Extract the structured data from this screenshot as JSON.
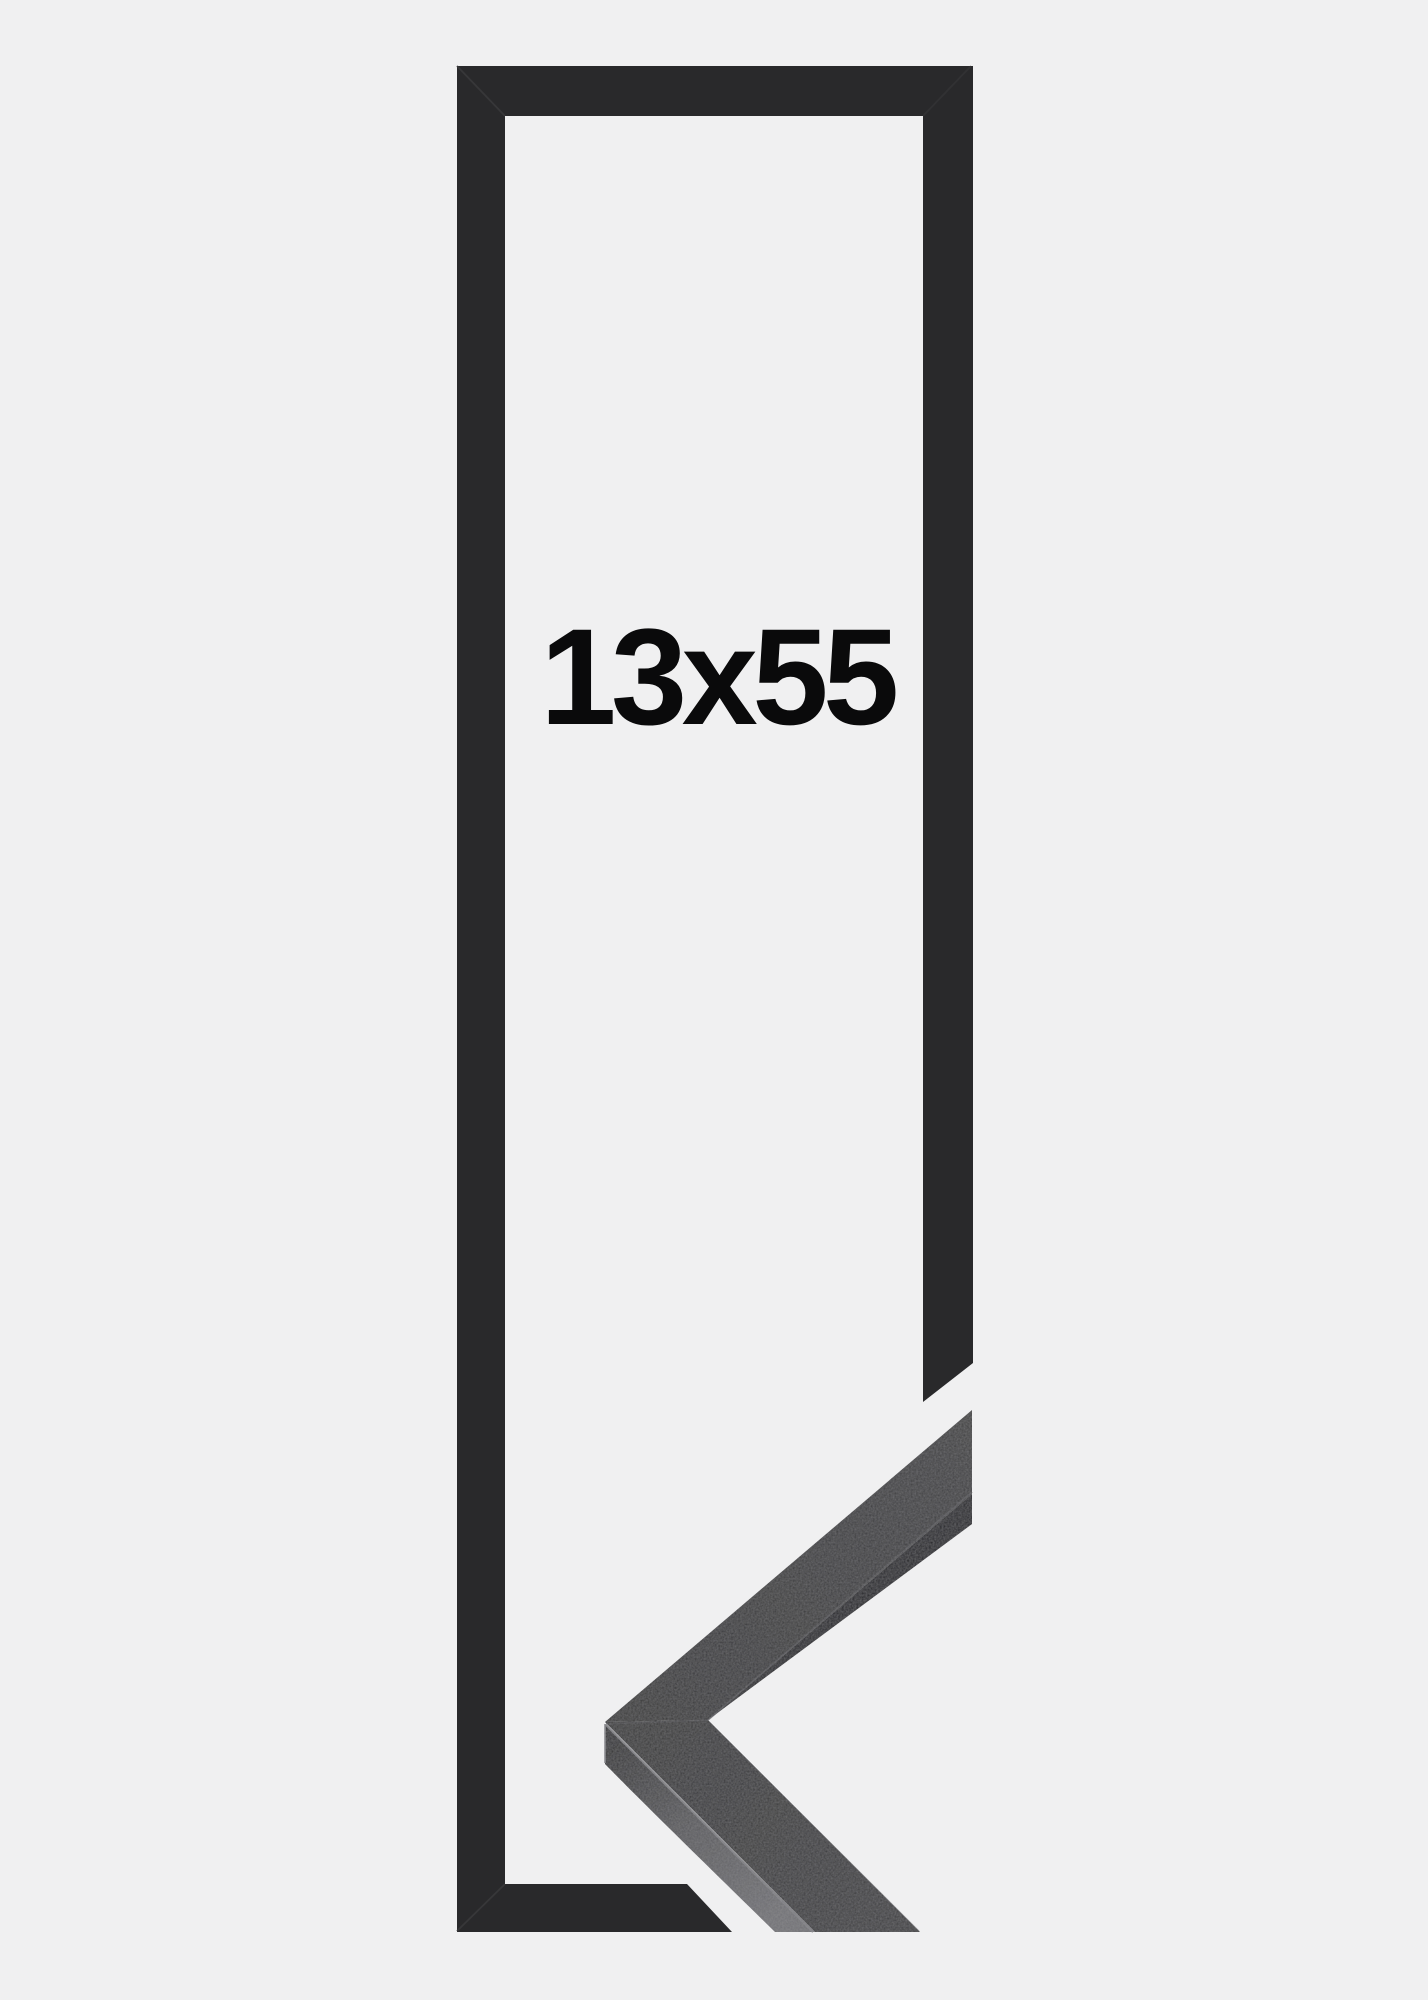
{
  "product": {
    "size_label": "13x55",
    "description": "black picture frame outline with mitered corner sample"
  },
  "colors": {
    "background": "#f0f0f1",
    "frame_graphic": "#29292b",
    "photo_face": "#39393b",
    "photo_edge_dark": "#1e1e20",
    "photo_side_light": "#565659",
    "arris_highlight": "#7e7e82",
    "label_text": "#0a0a0b"
  }
}
